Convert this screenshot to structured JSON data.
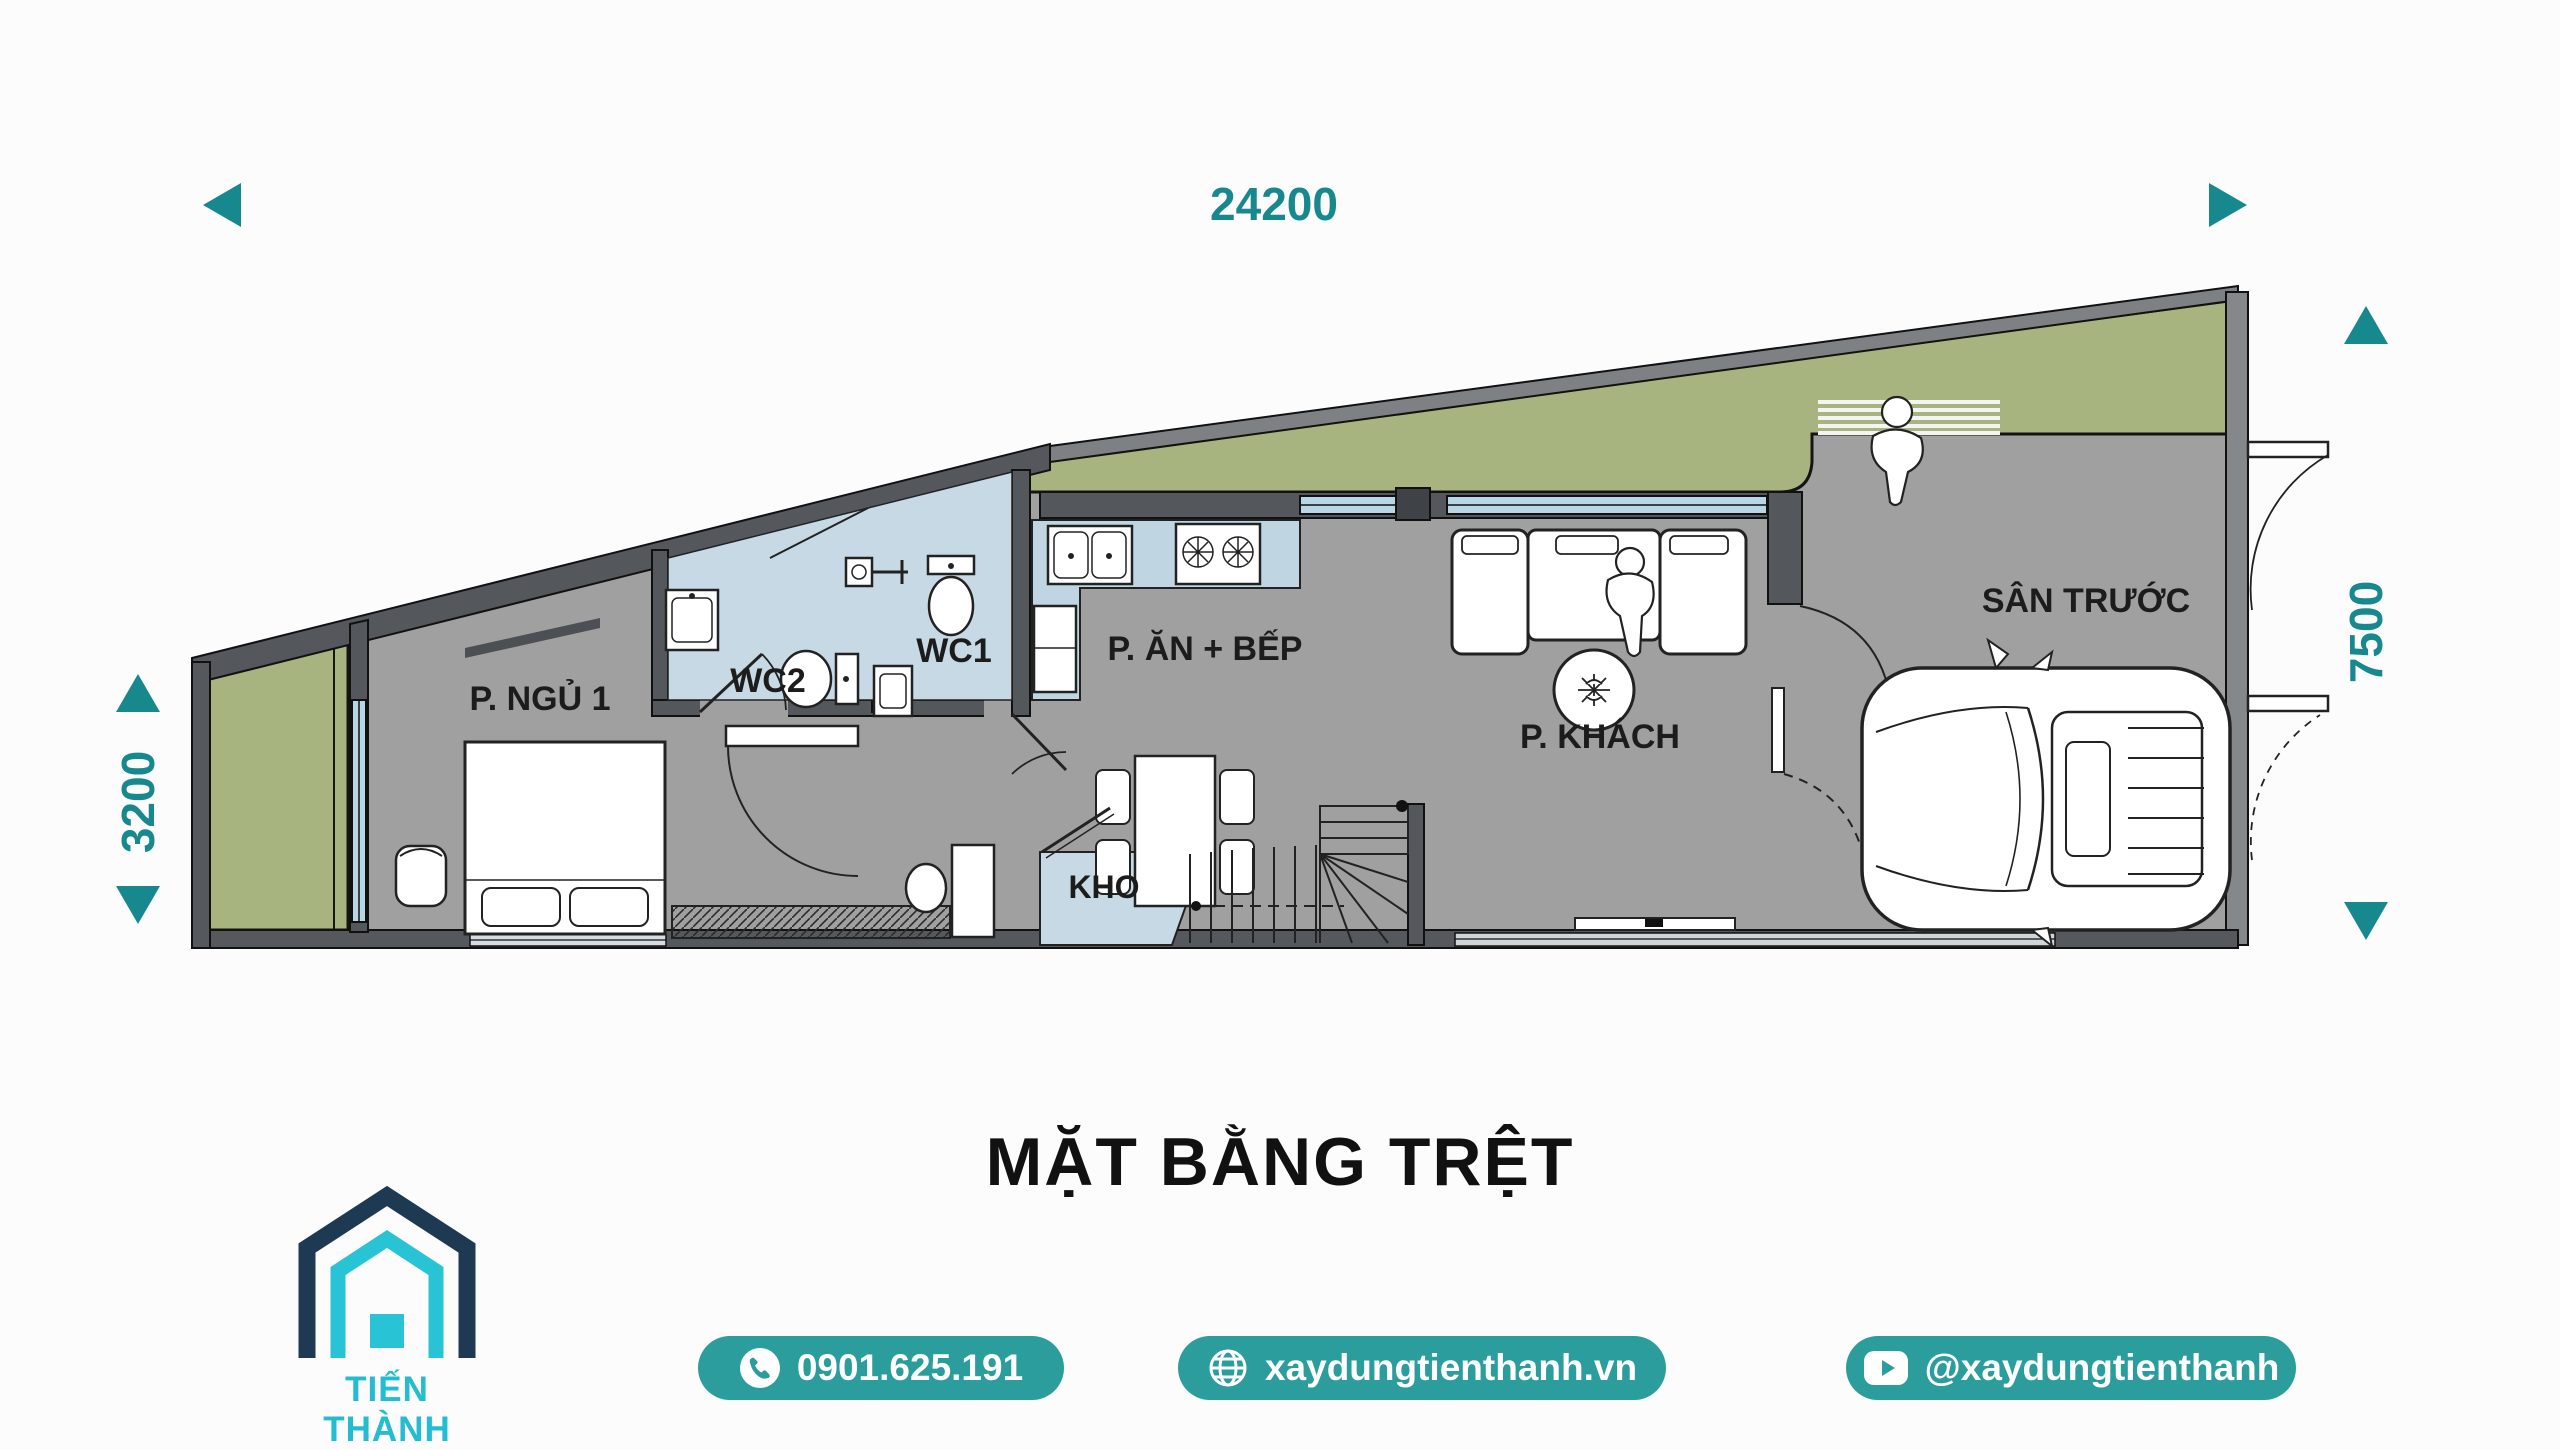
{
  "plan": {
    "title": "MẶT BẰNG TRỆT",
    "dimensions": {
      "top": "24200",
      "right": "7500",
      "left": "3200"
    },
    "rooms": [
      {
        "label": "P. NGỦ 1"
      },
      {
        "label": "WC2"
      },
      {
        "label": "WC1"
      },
      {
        "label": "P. ĂN + BẾP"
      },
      {
        "label": "KHO"
      },
      {
        "label": "P. KHÁCH"
      },
      {
        "label": "SÂN TRƯỚC"
      }
    ]
  },
  "footer": {
    "brand": "TIẾN THÀNH",
    "phone": "0901.625.191",
    "website": "xaydungtienthanh.vn",
    "social": "@xaydungtienthanh"
  },
  "colors": {
    "accent_teal": "#17898e",
    "badge_teal": "#2a9d9c",
    "logo_navy": "#1d3a52",
    "logo_cyan": "#28c4d6",
    "wall_dark": "#54575b",
    "floor_gray": "#a0a0a0",
    "garden_green": "#a7b480",
    "wetroom_blue": "#c7d9e4",
    "window_blue": "#b9d6e6"
  }
}
